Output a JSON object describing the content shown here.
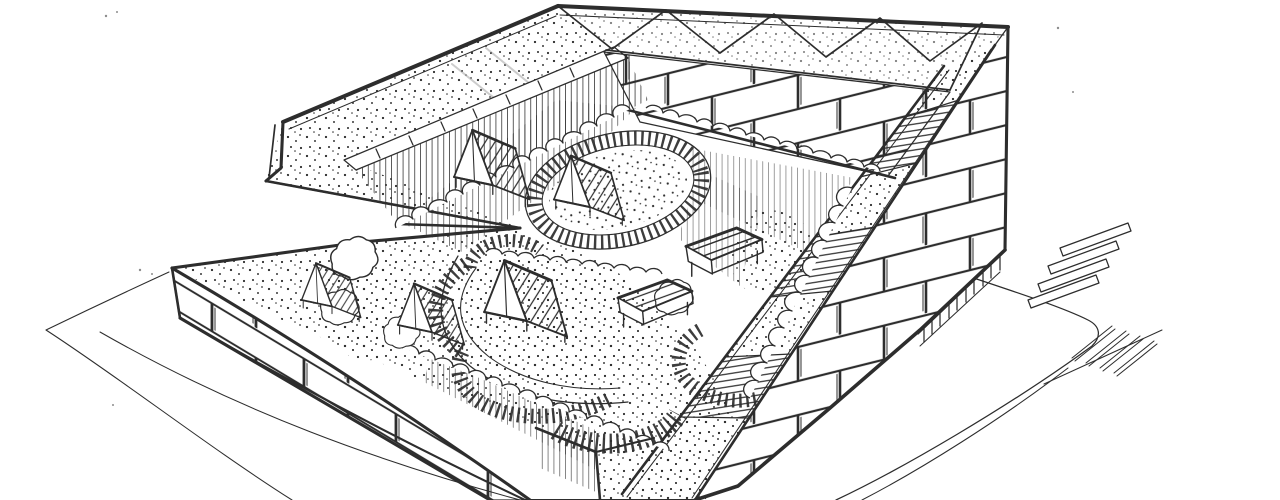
{
  "scene": {
    "title": "Courtyard block building - ink sketch",
    "description": "Hand-drawn axonometric pen sketch of a perimeter-block building with sloped speckled roofs, brick-banded facades, a diamond-folded roof band along the rear edge, and a long diagonal stair with landings climbing beside the right facade. The inner courtyard garden holds oval tick-marked paths around planted mounds, scalloped shrub rows and seven small gabled garden pavilions. Freehand ground lines, a sidewalk corner and two groups of crosswalk stripes sit at the lower right.",
    "labels": {
      "building": "perimeter block building",
      "roof_back_left": "sloped speckled roof, north-west wing",
      "roof_front_left": "sloped speckled roof, south-west wing",
      "roof_diamond_band": "diamond-folded roof band, north edge",
      "facade_right": "brick-banded east facade",
      "facade_front_left": "brick-banded low south-west facade",
      "inner_wall_nw": "courtyard wall with vertical hatching",
      "inner_wall_ne": "courtyard wall with brick courses",
      "stair_ramp": "diagonal stair with stippled landings",
      "railing": "railing with balusters at facade base",
      "courtyard": "inner garden courtyard",
      "ring_path": "oval tick-marked garden path",
      "swirl_path": "looping tick-marked garden path",
      "garden_mounds": "stippled planting mounds",
      "pavilions": "gabled garden pavilions",
      "pavilion_count": 7,
      "shrubs": "scalloped shrub rows",
      "sidewalk": "sidewalk curb lines at street corner",
      "crosswalk_upper": "crosswalk stripes, upper group",
      "crosswalk_lower": "crosswalk stripes, lower group",
      "ground": "freehand ground lines"
    }
  },
  "colors": {
    "ink": "#2d2d2d",
    "ink_soft": "#9a9a9a",
    "paper": "#ffffff"
  }
}
